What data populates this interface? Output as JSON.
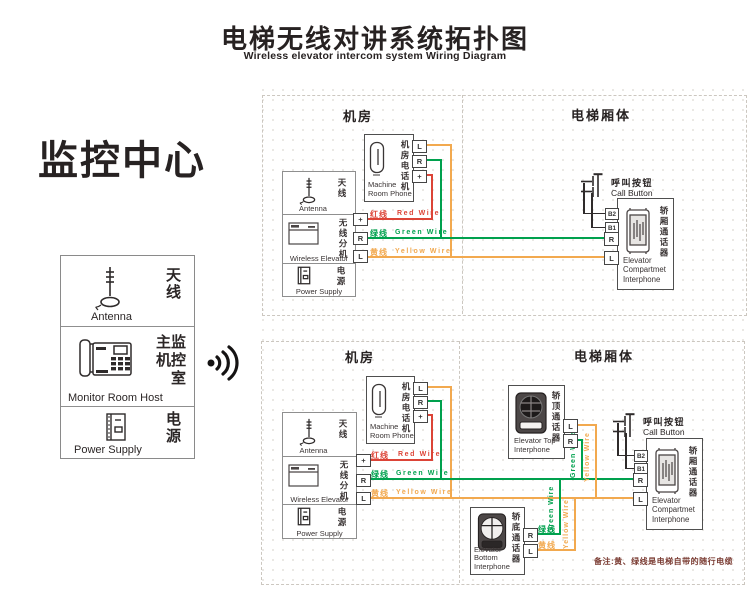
{
  "title": {
    "cn": "电梯无线对讲系统拓扑图",
    "en": "Wireless elevator intercom system Wiring Diagram"
  },
  "monitor_center": {
    "heading": "监控中心",
    "antenna": {
      "cn": "天线",
      "en": "Antenna"
    },
    "host": {
      "cn": "主监\n机控\n室",
      "en": "Monitor Room Host"
    },
    "power": {
      "cn": "电源",
      "en": "Power Supply"
    }
  },
  "sections": {
    "machine_room": "机房",
    "elevator_body": "电梯厢体"
  },
  "components": {
    "machine_room_phone": {
      "cn": "机房电话机",
      "en": "Machine\nRoom Phone"
    },
    "antenna": {
      "cn": "天线",
      "en": "Antenna"
    },
    "wireless_extension": {
      "cn": "无线分机",
      "en": "Wireless Elevator"
    },
    "power_supply": {
      "cn": "电源",
      "en": "Power Supply"
    },
    "call_button": {
      "cn": "呼叫按钮",
      "en": "Call Button"
    },
    "compartment_interphone": {
      "cn": "轿厢通话器",
      "en": "Elevator\nCompartmet\nInterphone"
    },
    "top_interphone": {
      "cn": "轿顶通话器",
      "en": "Elevator Top\nInterphone"
    },
    "bottom_interphone": {
      "cn": "轿底通话器",
      "en": "Elevator Bottom\nInterphone"
    }
  },
  "terminals": {
    "l": "L",
    "r": "R",
    "plus": "+",
    "b2": "B2",
    "b1": "B1"
  },
  "wires": {
    "red": {
      "cn": "红线",
      "en": "Red Wire",
      "color": "#dc4437"
    },
    "green": {
      "cn": "绿线",
      "en": "Green Wire",
      "color": "#00a14e"
    },
    "yellow": {
      "cn": "黄线",
      "en": "Yellow Wire",
      "color": "#f2a94f"
    }
  },
  "note": "备注:黄、绿线是电梯自带的随行电缆"
}
